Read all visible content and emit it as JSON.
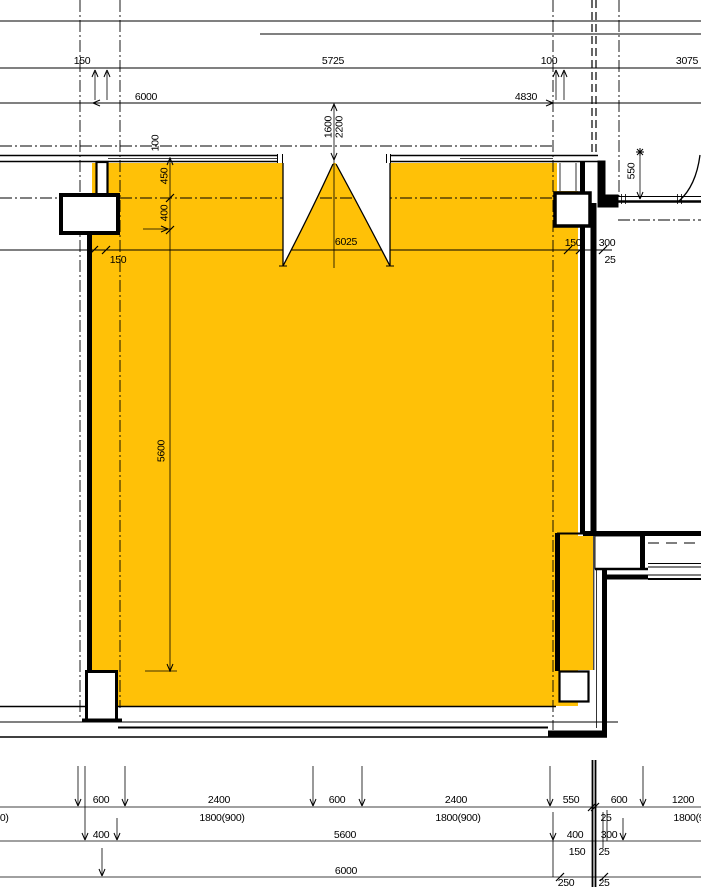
{
  "drawing_type": "architectural-floor-plan",
  "colors": {
    "room_fill": "#FFC107",
    "line": "#000000",
    "dashed_gray": "#555555",
    "background": "#FFFFFF"
  },
  "dims": {
    "top": {
      "v150": "150",
      "v5725": "5725",
      "v100": "100",
      "v3075": "3075",
      "v6000": "6000",
      "v4830": "4830",
      "v1600": "1600",
      "v2200": "2200",
      "v100_wall": "100"
    },
    "left": {
      "v450": "450",
      "v400": "400",
      "v150": "150",
      "v5600": "5600"
    },
    "interior": {
      "v6025": "6025",
      "v150": "150",
      "v300": "300",
      "v25": "25"
    },
    "right": {
      "v550": "550"
    },
    "bottom": {
      "row1": [
        "600",
        "2400",
        "600",
        "2400",
        "550",
        "600",
        "1200"
      ],
      "row1b": [
        "1800(900)",
        "1800(900)",
        "1800(900)",
        "25",
        "1800(900)"
      ],
      "row2": [
        "400",
        "5600",
        "400",
        "300"
      ],
      "row2b": [
        "150",
        "25"
      ],
      "row3": [
        "6000"
      ],
      "row3b": [
        "250",
        "25"
      ]
    }
  }
}
